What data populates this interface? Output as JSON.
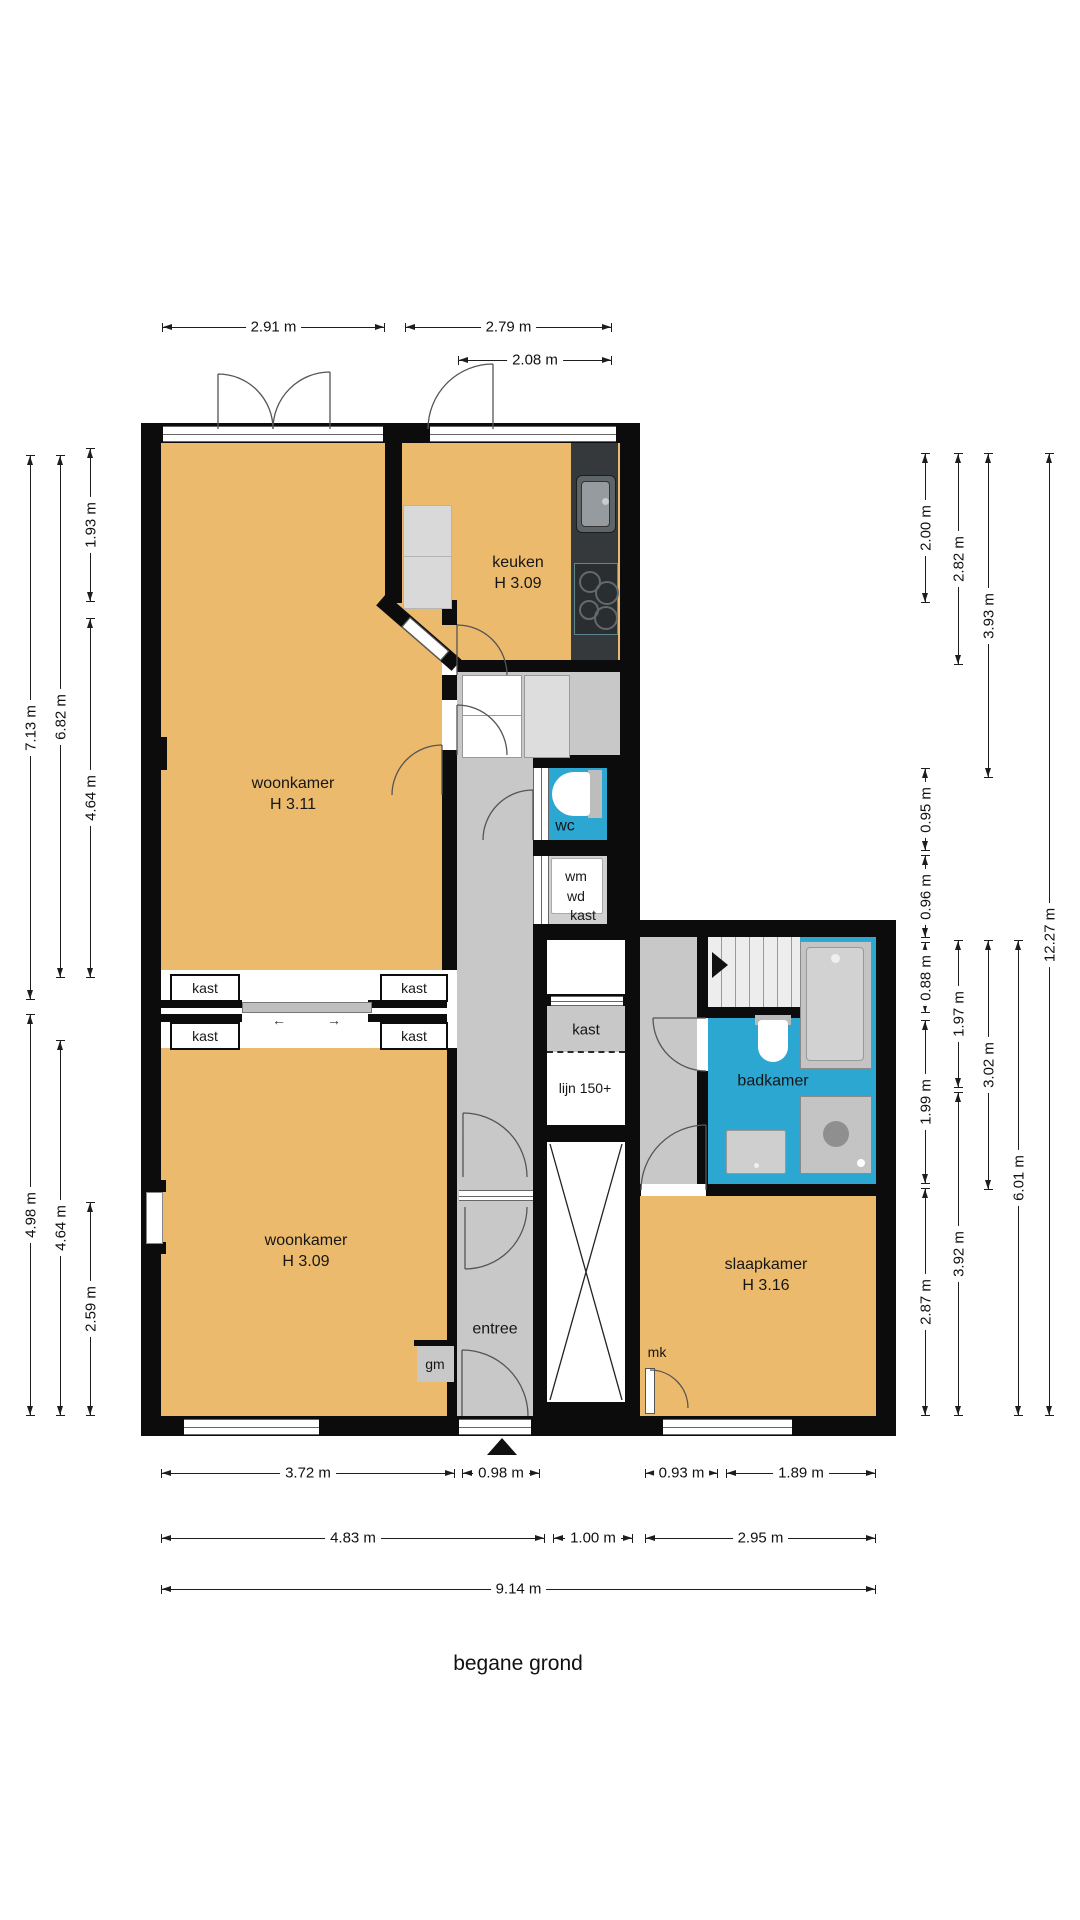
{
  "title": "begane grond",
  "rooms": {
    "woonkamer_top": {
      "name": "woonkamer",
      "height": "H 3.11"
    },
    "keuken": {
      "name": "keuken",
      "height": "H 3.09"
    },
    "woonkamer_bottom": {
      "name": "woonkamer",
      "height": "H 3.09"
    },
    "slaapkamer": {
      "name": "slaapkamer",
      "height": "H 3.16"
    },
    "badkamer": {
      "name": "badkamer"
    },
    "wc": {
      "name": "wc"
    },
    "entree": {
      "name": "entree"
    },
    "kast_center": {
      "name": "kast"
    },
    "lijn150": {
      "name": "lijn 150+"
    },
    "wm_wd": {
      "line1": "wm",
      "line2": "wd",
      "label": "kast"
    },
    "kast_divider": [
      "kast",
      "kast",
      "kast",
      "kast"
    ],
    "mk": "mk",
    "gm": "gm"
  },
  "dimensions": {
    "top": [
      "2.91 m",
      "2.79 m",
      "2.08 m"
    ],
    "left": [
      "7.13 m",
      "6.82 m",
      "1.93 m",
      "4.64 m",
      "4.98 m",
      "4.64 m",
      "2.59 m"
    ],
    "right": [
      "2.00 m",
      "0.95 m",
      "0.96 m",
      "0.88 m",
      "1.99 m",
      "2.87 m",
      "2.82 m",
      "1.97 m",
      "3.92 m",
      "3.93 m",
      "3.02 m",
      "6.01 m",
      "12.27 m"
    ],
    "bottom": [
      "3.72 m",
      "0.98 m",
      "0.93 m",
      "1.89 m",
      "4.83 m",
      "1.00 m",
      "2.95 m",
      "9.14 m"
    ]
  },
  "icons": {
    "slide_left": "←",
    "slide_right": "→"
  },
  "colors": {
    "room_fill": "#ECBA6C",
    "hall_fill": "#C8C8C8",
    "wet_room_fill": "#2BA7D2",
    "wall": "#0C0C0C",
    "counter": "#35393B",
    "fixture_gray": "#C4C4C4"
  }
}
